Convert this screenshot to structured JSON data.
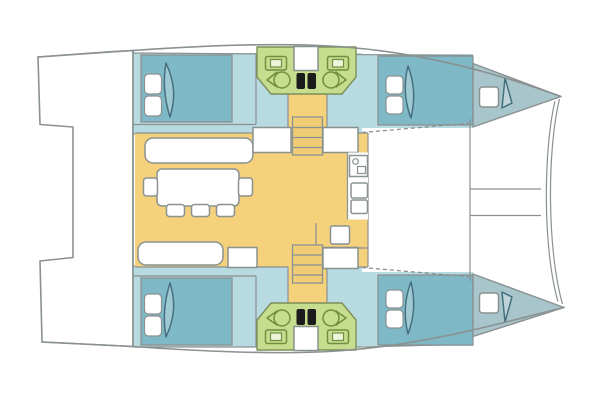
{
  "diagram": {
    "type": "floor-plan",
    "subject": "catamaran sailboat accommodation plan, bows to the right",
    "areas": [
      "cockpit platform (aft)",
      "port aft cabin with double berth",
      "port head with twin sinks and toilets",
      "port forward cabin with double berth",
      "port bow locker with deck hatch",
      "central salon with dining table, five stools and two settees",
      "galley units on forward bulkhead",
      "companionway steps to each hull",
      "starboard aft cabin with double berth",
      "starboard head with twin sinks and toilets",
      "starboard forward cabin with double berth",
      "starboard bow locker with deck hatch",
      "foredeck crossbeam and bow bridle between hulls"
    ]
  },
  "colors": {
    "background": "#ffffff",
    "outline": "#8a9191",
    "hull_floor": "#b7dbe1",
    "bed": "#7fb8c6",
    "bow_deck": "#a8c5cc",
    "head_green": "#c6dc8e",
    "head_outline": "#7d8f58",
    "head_fixture": "#6f8f3f",
    "salon_yellow": "#f5d17c",
    "ladder_yellow": "#f0cd74",
    "furniture_white": "#ffffff",
    "door_dark": "#45707e",
    "fixture_black": "#1b1b1b"
  }
}
